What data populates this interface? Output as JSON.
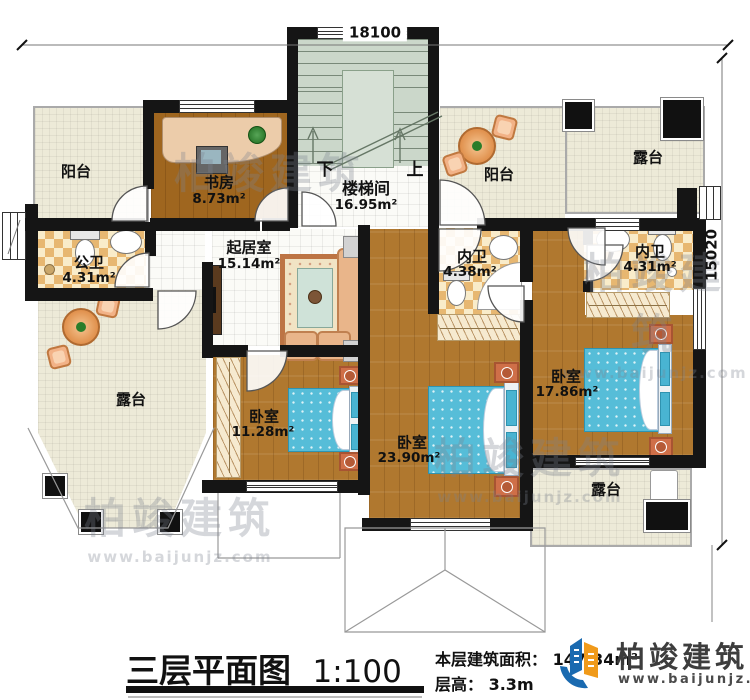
{
  "dimensions": {
    "width": "18100",
    "height": "15020"
  },
  "rooms": {
    "balcony_tl": {
      "name": "阳台"
    },
    "study": {
      "name": "书房",
      "area": "8.73m²"
    },
    "stairwell": {
      "name": "楼梯间",
      "area": "16.95m²",
      "down": "下",
      "up": "上"
    },
    "balcony_tr": {
      "name": "阳台"
    },
    "terrace_tr": {
      "name": "露台"
    },
    "public_bath": {
      "name": "公卫",
      "area": "4.31m²"
    },
    "living": {
      "name": "起居室",
      "area": "15.14m²"
    },
    "bath_inner_1": {
      "name": "内卫",
      "area": "4.38m²"
    },
    "bath_inner_2": {
      "name": "内卫",
      "area": "4.31m²"
    },
    "terrace_left": {
      "name": "露台"
    },
    "bedroom_small": {
      "name": "卧室",
      "area": "11.28m²"
    },
    "bedroom_large": {
      "name": "卧室",
      "area": "23.90m²"
    },
    "bedroom_mid": {
      "name": "卧室",
      "area": "17.86m²"
    },
    "terrace_br": {
      "name": "露台"
    }
  },
  "title_block": {
    "title": "三层平面图",
    "scale": "1:100",
    "area_label": "本层建筑面积：",
    "area_value": "147.34m²",
    "floor_height_label": "层高：",
    "floor_height_value": "3.3m"
  },
  "brand": {
    "name": "柏竣建筑",
    "website": "www.baijunjz.com"
  },
  "watermark": {
    "text": "柏竣建筑",
    "url": "www.baijunjz.com"
  },
  "colors": {
    "wall": "#151515",
    "wood_floor": "#b0782f",
    "tile_floor": "#edead8",
    "bath_tile": "#e7b771",
    "stairs": "#cbd7ca",
    "bed": "#56bdd8",
    "logo_blue": "#1a6ab0",
    "logo_orange": "#f09a1a"
  }
}
